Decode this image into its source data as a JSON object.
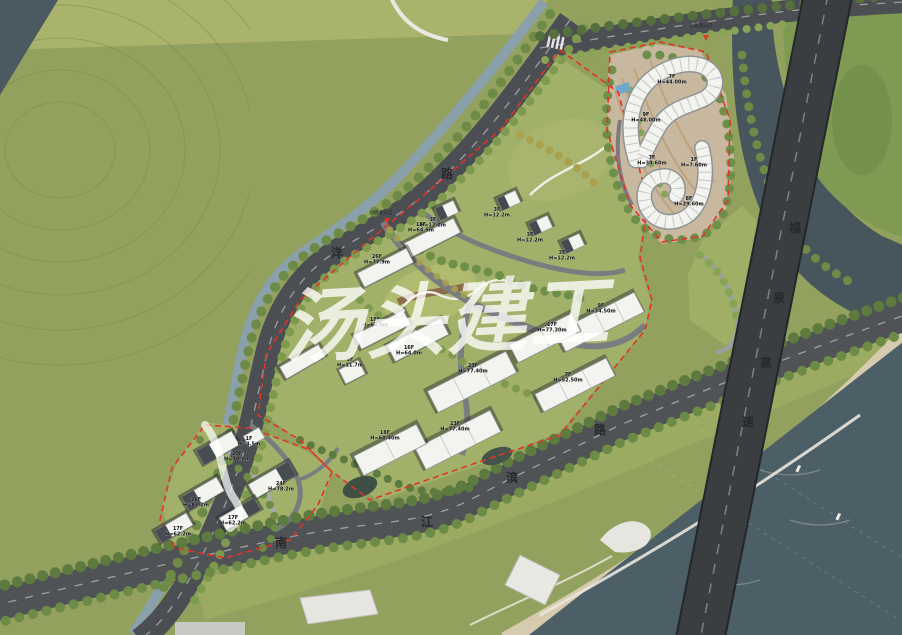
{
  "plan": {
    "type": "residential-masterplan-rendering",
    "watermark": {
      "text": "汤头建工"
    },
    "roads": [
      {
        "id": "road-yang",
        "chars": [
          {
            "c": "路",
            "x": 447,
            "y": 178
          },
          {
            "c": "洋",
            "x": 337,
            "y": 257
          }
        ]
      },
      {
        "id": "road-nanjiangbin",
        "chars": [
          {
            "c": "南",
            "x": 281,
            "y": 547
          },
          {
            "c": "江",
            "x": 427,
            "y": 526
          },
          {
            "c": "滨",
            "x": 512,
            "y": 482
          },
          {
            "c": "路",
            "x": 600,
            "y": 434
          }
        ]
      },
      {
        "id": "road-fuquan-expressway",
        "chars": [
          {
            "c": "福",
            "x": 795,
            "y": 232
          },
          {
            "c": "泉",
            "x": 779,
            "y": 302
          },
          {
            "c": "高",
            "x": 766,
            "y": 367
          },
          {
            "c": "速",
            "x": 748,
            "y": 426
          }
        ]
      }
    ],
    "entrances": [
      {
        "label": "小区主入口",
        "x": 381,
        "y": 214,
        "ax": 387,
        "ay": 222
      },
      {
        "label": "小区次入口",
        "x": 701,
        "y": 27,
        "ax": 706,
        "ay": 39
      }
    ],
    "buildings": [
      {
        "floors": "7F",
        "height": "H=44.00m",
        "x": 672,
        "y": 78
      },
      {
        "floors": "9F",
        "height": "H=48.00m",
        "x": 646,
        "y": 116
      },
      {
        "floors": "7F",
        "height": "H=34.60m",
        "x": 652,
        "y": 159
      },
      {
        "floors": "1F",
        "height": "H=7.60m",
        "x": 694,
        "y": 161
      },
      {
        "floors": "8F",
        "height": "H=29.60m",
        "x": 689,
        "y": 200
      },
      {
        "floors": "3F",
        "height": "H=12.2m",
        "x": 433,
        "y": 221
      },
      {
        "floors": "3F",
        "height": "H=12.2m",
        "x": 497,
        "y": 211
      },
      {
        "floors": "3F",
        "height": "H=12.2m",
        "x": 530,
        "y": 236
      },
      {
        "floors": "3F",
        "height": "H=12.2m",
        "x": 562,
        "y": 254
      },
      {
        "floors": "18F",
        "height": "H=64.5m",
        "x": 421,
        "y": 226
      },
      {
        "floors": "26F",
        "height": "H=77.9m",
        "x": 377,
        "y": 258
      },
      {
        "floors": "18F",
        "height": "H=64.5m",
        "x": 375,
        "y": 321
      },
      {
        "floors": "16F",
        "height": "H=64.0m",
        "x": 409,
        "y": 349
      },
      {
        "floors": "3F",
        "height": "H=11.7m",
        "x": 350,
        "y": 361
      },
      {
        "floors": "9F",
        "height": "H=34.50m",
        "x": 601,
        "y": 307
      },
      {
        "floors": "17F",
        "height": "H=77.30m",
        "x": 552,
        "y": 326
      },
      {
        "floors": "7F",
        "height": "H=52.50m",
        "x": 568,
        "y": 376
      },
      {
        "floors": "23F",
        "height": "H=77.40m",
        "x": 473,
        "y": 367
      },
      {
        "floors": "23F",
        "height": "H=77.40m",
        "x": 455,
        "y": 425
      },
      {
        "floors": "18F",
        "height": "H=60.40m",
        "x": 385,
        "y": 434
      },
      {
        "floors": "1F",
        "height": "H=4.5m",
        "x": 249,
        "y": 440
      },
      {
        "floors": "20F",
        "height": "H=78.0m",
        "x": 237,
        "y": 455
      },
      {
        "floors": "24F",
        "height": "H=78.2m",
        "x": 281,
        "y": 485
      },
      {
        "floors": "26F",
        "height": "H=81.2m",
        "x": 196,
        "y": 501
      },
      {
        "floors": "17F",
        "height": "H=62.2m",
        "x": 233,
        "y": 519
      },
      {
        "floors": "17F",
        "height": "H=62.2m",
        "x": 178,
        "y": 530
      }
    ],
    "colors": {
      "field": "#93a15e",
      "site_lawn": "#a2b169",
      "road": "#4b4e52",
      "expressway": "#3a3e41",
      "water": "#4d5f66",
      "river": "#46565c",
      "sand": "#d6cbae",
      "building": "#f3f3ef",
      "boundary_red": "#e03428",
      "tree_dark": "#5d7a3f",
      "tree_light": "#87a355",
      "tree_olive": "#a8a14e",
      "canal": "#8aa0aa",
      "terrace_ground": "#c9b8a0",
      "pool_blue": "#6fa7c8"
    }
  }
}
